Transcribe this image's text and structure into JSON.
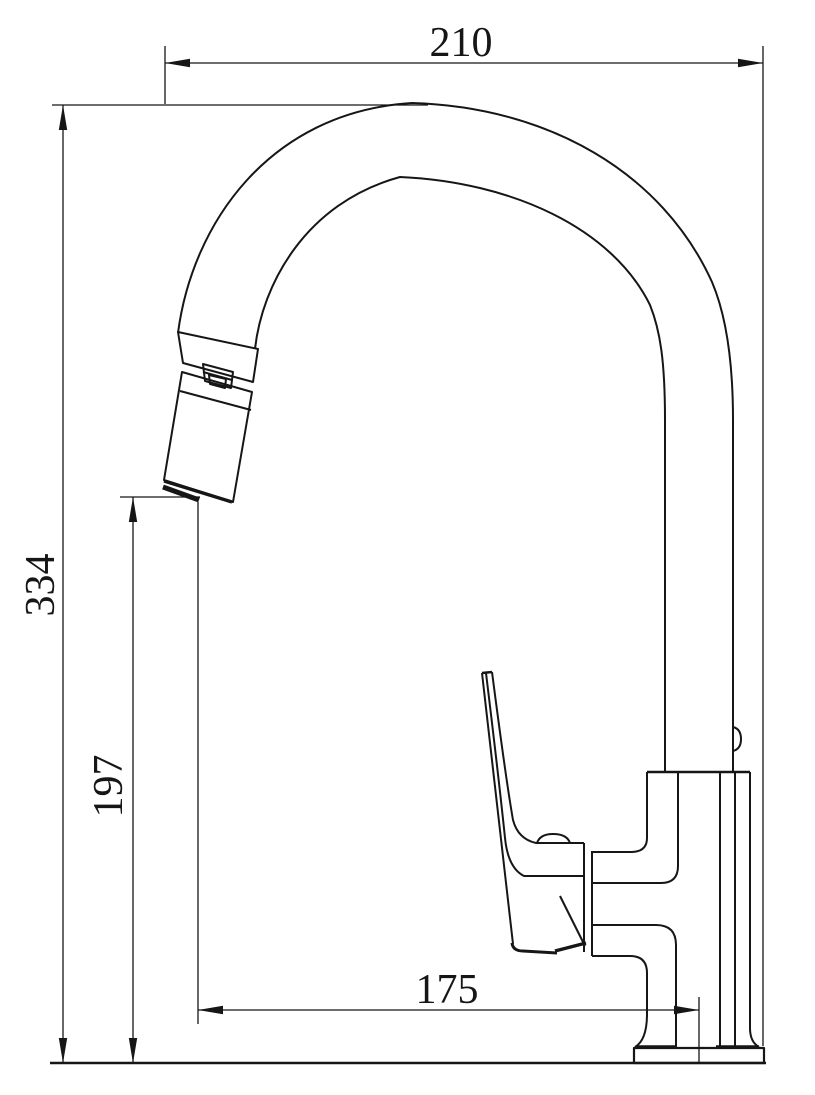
{
  "drawing": {
    "kind": "technical-dimension-drawing",
    "subject": "kitchen faucet side elevation with pull-out spray head",
    "background_color": "#ffffff",
    "line_color": "#161616",
    "dimensions": {
      "top_width": {
        "value": "210",
        "orientation": "horizontal",
        "position": "top"
      },
      "overall_height": {
        "value": "334",
        "orientation": "vertical",
        "position": "left-outer"
      },
      "spout_height": {
        "value": "197",
        "orientation": "vertical",
        "position": "left-inner"
      },
      "spout_reach": {
        "value": "175",
        "orientation": "horizontal",
        "position": "bottom"
      }
    }
  }
}
